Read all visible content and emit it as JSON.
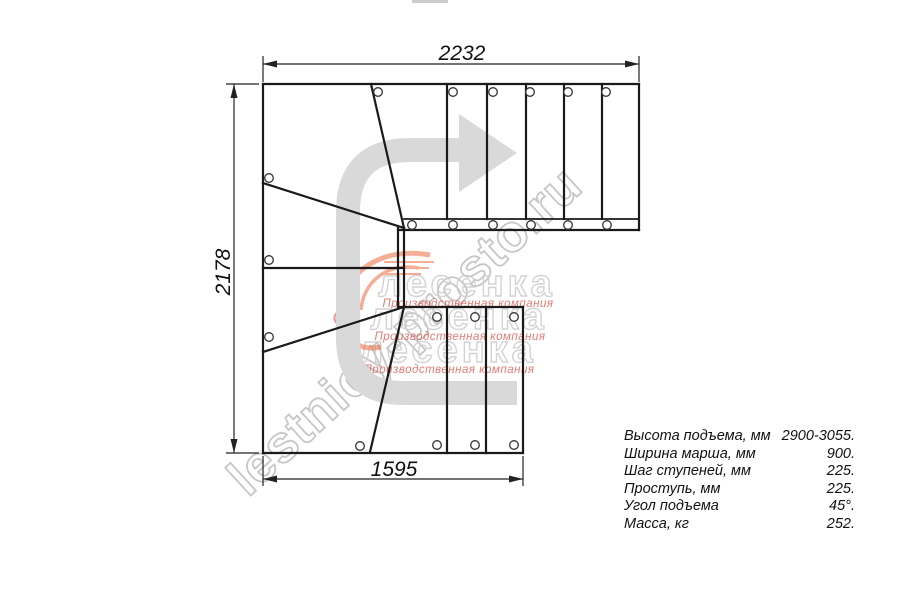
{
  "dimensions": {
    "top_mm": "2232",
    "left_mm": "2178",
    "bottom_mm": "1595"
  },
  "specs": {
    "rows": [
      {
        "label": "Высота подъема, мм",
        "value": "2900-3055."
      },
      {
        "label": "Ширина марша, мм",
        "value": "900."
      },
      {
        "label": "Шаг ступеней, мм",
        "value": "225."
      },
      {
        "label": "Проступь, мм",
        "value": "225."
      },
      {
        "label": "Угол подъема",
        "value": "45°."
      },
      {
        "label": "Масса, кг",
        "value": "252."
      }
    ]
  },
  "watermarks": {
    "site": "lestnicy-prosto.ru",
    "brand": "лесенка",
    "tagline": "Производственная компания"
  },
  "colors": {
    "line": "#1a1a1a",
    "dimension": "#222222",
    "arrow_gray": "#d9d9d9",
    "watermark_gray": "#c7c7c7",
    "brand_red": "#dd5348",
    "brand_orange": "#ee6b3f"
  }
}
